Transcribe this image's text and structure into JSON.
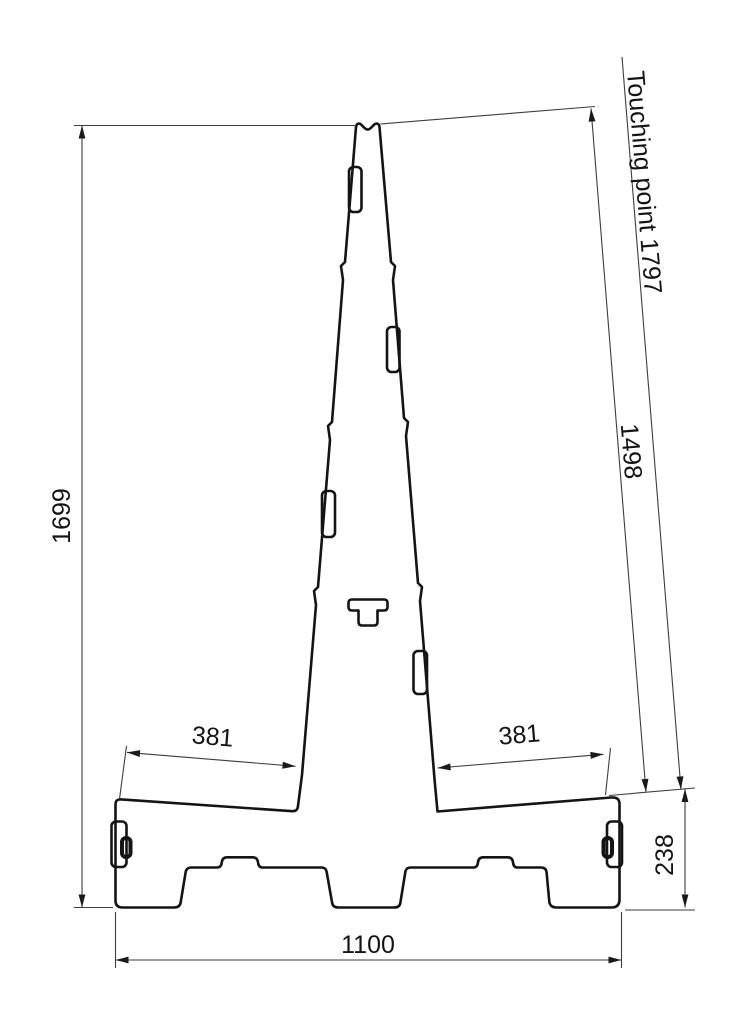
{
  "colors": {
    "ink": "#141414",
    "dimension_lines": "#3d3d3d",
    "background": "#ffffff"
  },
  "drawing": {
    "type": "technical-profile-drawing",
    "dimensions": {
      "total_height": "1699",
      "total_width": "1100",
      "left_base_span": "381",
      "right_base_span": "381",
      "base_height": "238",
      "slant_height": "1498",
      "touching_point": "Touching point 1797"
    }
  }
}
